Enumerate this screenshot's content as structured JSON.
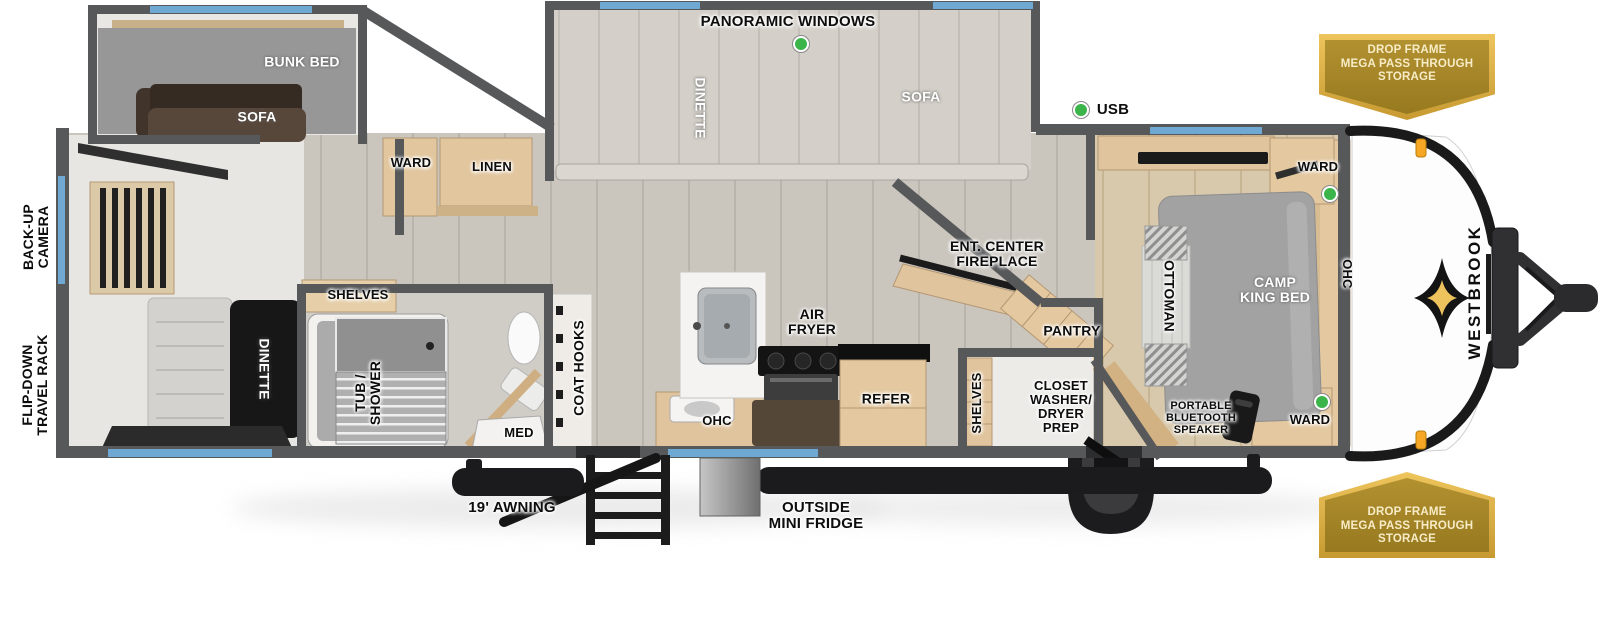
{
  "floorplan": {
    "brand": "WESTBROOK",
    "badge_storage": "DROP FRAME\nMEGA PASS THROUGH\nSTORAGE",
    "callouts": {
      "panoramic_windows": "PANORAMIC WINDOWS",
      "usb": "USB",
      "back_up_camera": "BACK-UP\nCAMERA",
      "flip_down_travel_rack": "FLIP-DOWN\nTRAVEL RACK",
      "awning": "19' AWNING",
      "outside_mini_fridge": "OUTSIDE\nMINI FRIDGE"
    },
    "rooms": {
      "bunk_room": {
        "bunk_bed": "BUNK BED",
        "sofa": "SOFA"
      },
      "living_slide": {
        "dinette": "DINETTE",
        "sofa": "SOFA"
      },
      "rear": {
        "dinette": "DINETTE"
      },
      "hall": {
        "ward": "WARD",
        "linen": "LINEN"
      },
      "bathroom": {
        "shelves": "SHELVES",
        "tub_shower": "TUB /\nSHOWER",
        "med": "MED",
        "coat_hooks": "COAT HOOKS"
      },
      "kitchen": {
        "ohc": "OHC",
        "air_fryer": "AIR\nFRYER",
        "refer": "REFER"
      },
      "mid": {
        "ent_center": "ENT. CENTER\nFIREPLACE",
        "pantry": "PANTRY",
        "shelves": "SHELVES",
        "closet": "CLOSET\nWASHER/\nDRYER\nPREP"
      },
      "bedroom": {
        "ottoman": "OTTOMAN",
        "bed": "CAMP\nKING BED",
        "ohc": "OHC",
        "ward_front": "WARD",
        "ward_rear": "WARD",
        "speaker": "PORTABLE\nBLUETOOTH\nSPEAKER"
      }
    },
    "colors": {
      "wall_gray": "#57585a",
      "window_blue": "#6fa8d2",
      "badge_gold": "#d9a940",
      "indicator_green": "#3bb54a",
      "cabinet_tan": "#e2c69e"
    }
  }
}
